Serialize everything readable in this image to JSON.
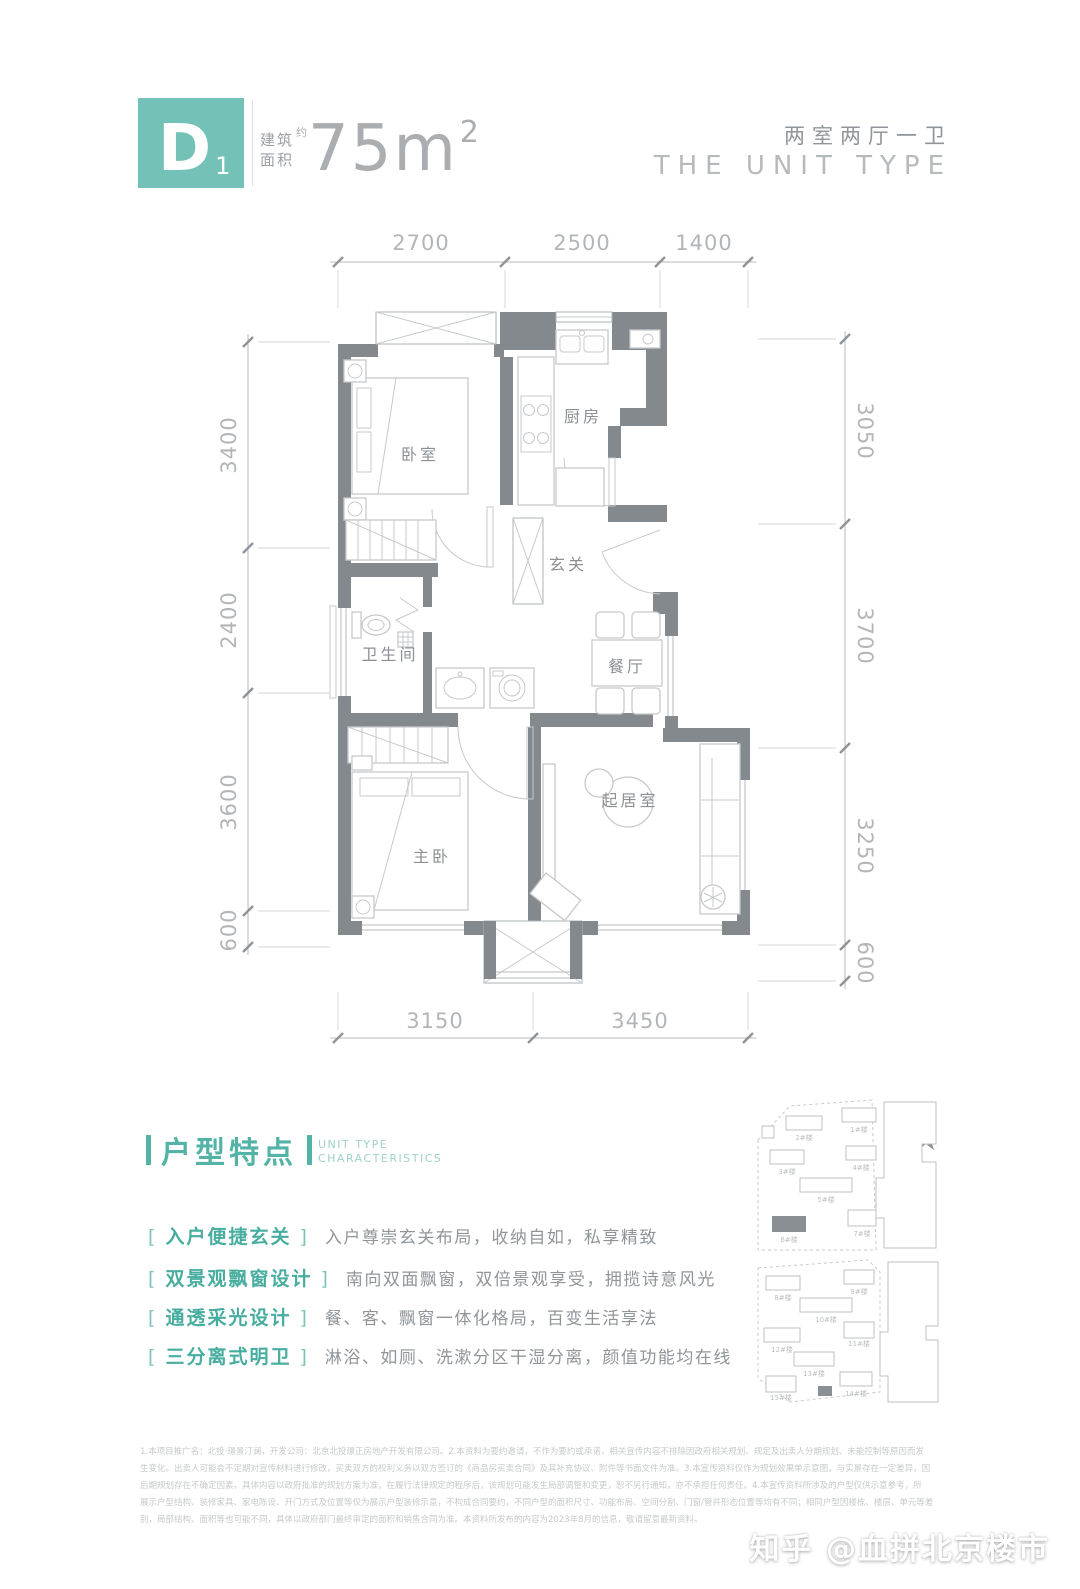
{
  "colors": {
    "accent": "#53b3a7",
    "badge": "#74c1b8",
    "wall": "#84898e"
  },
  "header": {
    "badge_letter": "D",
    "badge_sub": "1",
    "area_label_1": "建筑",
    "area_label_2": "面积",
    "area_approx": "约",
    "area_value": "75m",
    "area_sup": "2",
    "layout_cn": "两室两厅一卫",
    "layout_en": "THE UNIT TYPE"
  },
  "floorplan": {
    "rooms": {
      "bedroom": "卧室",
      "kitchen": "厨房",
      "foyer": "玄关",
      "bath": "卫生间",
      "dining": "餐厅",
      "master": "主卧",
      "living": "起居室"
    },
    "dimensions": {
      "top": [
        "2700",
        "2500",
        "1400"
      ],
      "bottom": [
        "3150",
        "3450"
      ],
      "left": [
        "3400",
        "2400",
        "3600",
        "600"
      ],
      "right": [
        "3050",
        "3700",
        "3250",
        "600"
      ]
    }
  },
  "features": {
    "title": "户型特点",
    "subtitle_1": "UNIT TYPE",
    "subtitle_2": "CHARACTERISTICS",
    "items": [
      {
        "tag": "入户便捷玄关",
        "desc": "入户尊崇玄关布局，收纳自如，私享精致"
      },
      {
        "tag": "双景观飘窗设计",
        "desc": "南向双面飘窗，双倍景观享受，拥揽诗意风光"
      },
      {
        "tag": "通透采光设计",
        "desc": "餐、客、飘窗一体化格局，百变生活享法"
      },
      {
        "tag": "三分离式明卫",
        "desc": "淋浴、如厕、洗漱分区干湿分离，颜值功能均在线"
      }
    ]
  },
  "siteplan": {
    "north": "N",
    "buildings": [
      "1#楼",
      "2#楼",
      "3#楼",
      "4#楼",
      "5#楼",
      "6#楼",
      "7#楼",
      "8#楼",
      "9#楼",
      "10#楼",
      "11#楼",
      "12#楼",
      "13#楼",
      "14#楼",
      "15#楼"
    ]
  },
  "disclaimer": {
    "lines": [
      "1.本项目推广名：北投·璟景汀澜，开发公司：北京北投璟正房地产开发有限公司。2.本资料为要约邀请，不作为要约或承诺，相关宣传内容不排除因政府相关规划、规定及出卖人分期规划、未能控制等原因而发",
      "生变化。出卖人可能会不定期对宣传材料进行修改，买卖双方的权利义务以双方签订的《商品房买卖合同》及其补充协议、附件等书面文件为准。3.本宣传资料仅作为规划效果单示意图，与实景存在一定差异，因",
      "后期规划存在不确定因素，具体内容以政府批准的规划方案为准，在履行法律规定的程序后，该规划可能发生局部调整和变更，恕不另行通知，亦不承担任何责任。4.本宣传资料所涉及的户型仅供示意参考，所",
      "展示户型结构、装修家具、家电陈设、开门方式及位置等仅为展示户型装修示意，不构成合同要约，不同户型的面积尺寸、功能布局、空间分割、门窗/管井形态位置等均有不同；相同户型因楼栋、楼层、单元等差",
      "别，局部结构、面积等也可能不同，具体以政府部门最终审定的面积和销售合同为准。本资料所发布的内容为2023年8月的信息，敬请留意最新资料。"
    ]
  },
  "watermark": {
    "text": "知乎 @血拼北京楼市"
  }
}
